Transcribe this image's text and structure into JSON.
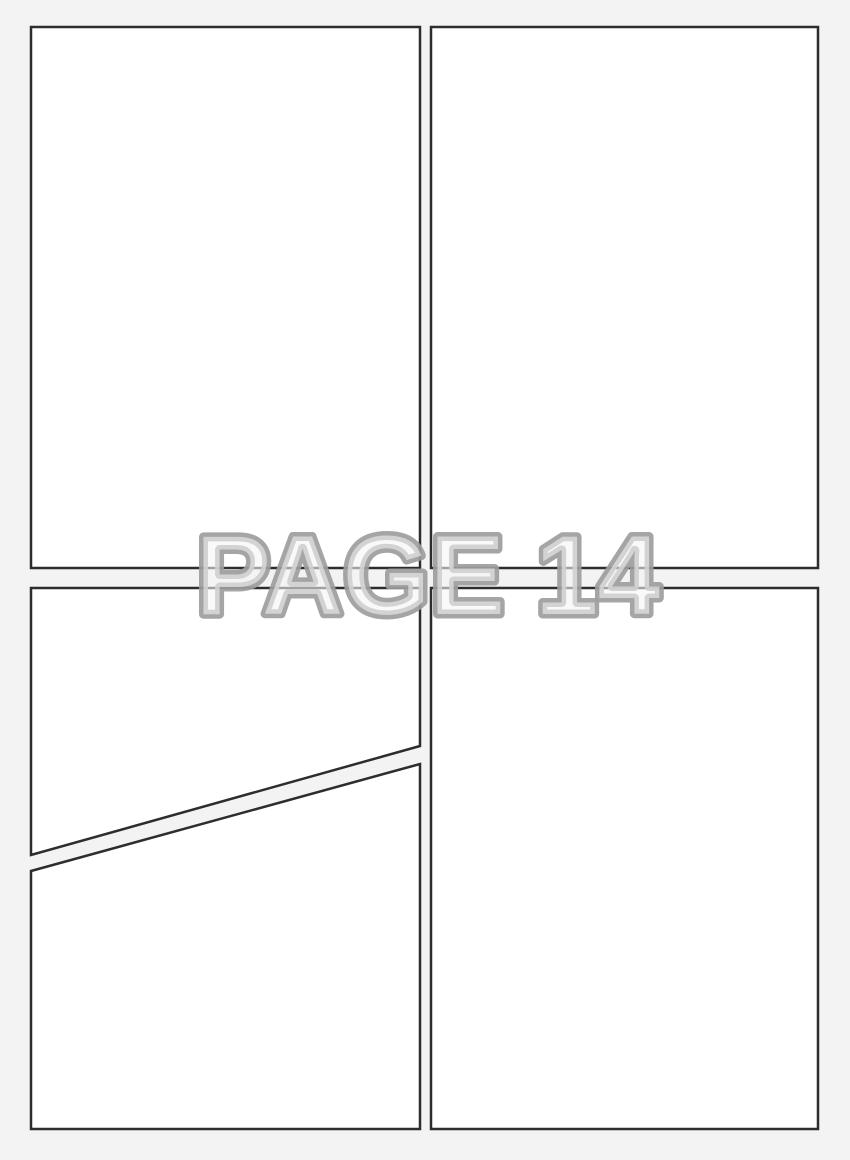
{
  "watermark": {
    "text": "PAGE 14"
  },
  "colors": {
    "background": "#f3f3f4",
    "panel_fill": "#ffffff",
    "panel_border": "#2d2d2d",
    "watermark_fill": "rgba(244,244,245,0.58)",
    "watermark_stroke": "rgba(157,157,157,0.92)"
  },
  "panels": [
    {
      "name": "panel-top-left",
      "points": "31,27 420,27 420,568 31,568"
    },
    {
      "name": "panel-top-right",
      "points": "431,27 818,27 818,568 431,568"
    },
    {
      "name": "panel-bottom-left-upper",
      "points": "31,588 420,588 420,746 31,855"
    },
    {
      "name": "panel-bottom-left-lower",
      "points": "31,871 420,764 420,1129 31,1129"
    },
    {
      "name": "panel-bottom-right",
      "points": "431,588 818,588 818,1129 431,1129"
    }
  ]
}
